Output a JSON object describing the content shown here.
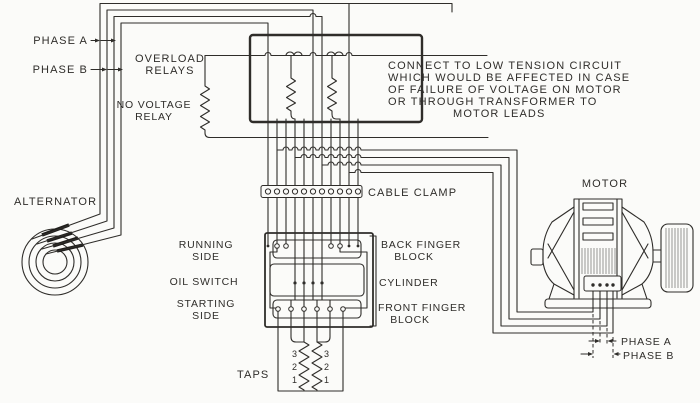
{
  "colors": {
    "ink": "#2f2d2a",
    "background": "#fbfbf9"
  },
  "labels": {
    "phase_a_top": "PHASE A",
    "phase_b_top": "PHASE B",
    "overload_relays_1": "OVERLOAD",
    "overload_relays_2": "RELAYS",
    "no_voltage_relay_1": "NO VOLTAGE",
    "no_voltage_relay_2": "RELAY",
    "alternator": "ALTERNATOR",
    "cable_clamp": "CABLE CLAMP",
    "running_side_1": "RUNNING",
    "running_side_2": "SIDE",
    "oil_switch": "OIL SWITCH",
    "starting_side_1": "STARTING",
    "starting_side_2": "SIDE",
    "back_finger_1": "BACK FINGER",
    "back_finger_2": "BLOCK",
    "cylinder": "CYLINDER",
    "front_finger_1": "FRONT FINGER",
    "front_finger_2": "BLOCK",
    "taps": "TAPS",
    "motor": "MOTOR",
    "phase_a_bottom": "PHASE A",
    "phase_b_bottom": "PHASE B"
  },
  "note_lines": [
    "CONNECT TO LOW TENSION CIRCUIT",
    "WHICH WOULD BE AFFECTED IN CASE",
    "OF FAILURE OF VOLTAGE ON MOTOR",
    "OR THROUGH TRANSFORMER TO",
    "MOTOR LEADS"
  ],
  "tap_numbers": [
    "3",
    "2",
    "1"
  ]
}
